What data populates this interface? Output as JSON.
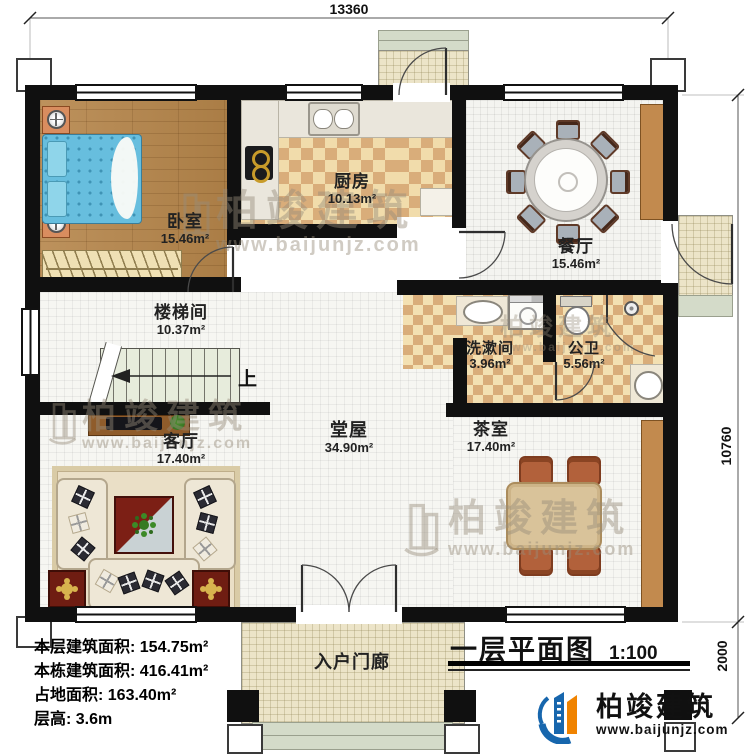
{
  "dimensions": {
    "top": "13360",
    "right_main": "10760",
    "right_porch": "2000"
  },
  "rooms": {
    "bedroom": {
      "name": "卧室",
      "area": "15.46m²"
    },
    "kitchen": {
      "name": "厨房",
      "area": "10.13m²"
    },
    "dining": {
      "name": "餐厅",
      "area": "15.46m²"
    },
    "stairwell": {
      "name": "楼梯间",
      "area": "10.37m²"
    },
    "washroom": {
      "name": "洗漱间",
      "area": "3.96m²"
    },
    "bathroom": {
      "name": "公卫",
      "area": "5.56m²"
    },
    "living": {
      "name": "客厅",
      "area": "17.40m²"
    },
    "hall": {
      "name": "堂屋",
      "area": "34.90m²"
    },
    "tearoom": {
      "name": "茶室",
      "area": "17.40m²"
    },
    "entry_porch": {
      "name": "入户门廊"
    }
  },
  "stairs": {
    "direction_label": "上"
  },
  "info": {
    "lines": [
      {
        "text": "本层建筑面积: 154.75m²"
      },
      {
        "text": "本栋建筑面积: 416.41m²"
      },
      {
        "text": "占地面积: 163.40m²"
      },
      {
        "text": "层高: 3.6m"
      }
    ]
  },
  "title": {
    "text": "一层平面图",
    "scale": "1:100"
  },
  "brand": {
    "name": "柏竣建筑",
    "url": "www.baijunjz.com"
  },
  "watermark": {
    "name": "柏竣建筑",
    "url": "www.baijunjz.com"
  },
  "colors": {
    "wall": "#101010",
    "brand_blue": "#1766ad",
    "brand_orange": "#f08300",
    "wood_floor": "#b5854a",
    "checker_tan": "#d9ad7a",
    "tile": "#f6f6f2"
  }
}
